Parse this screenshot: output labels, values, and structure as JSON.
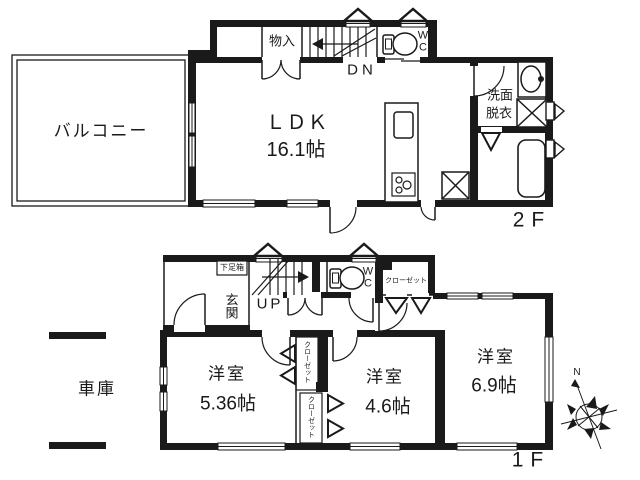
{
  "colors": {
    "line": "#1a1a1a",
    "background": "#ffffff"
  },
  "floor2": {
    "label": "2F",
    "balcony": "バルコニー",
    "ldk": "ＬＤＫ",
    "ldk_size": "16.1帖",
    "storage": "物入",
    "stairs": "DN",
    "wc_w": "W",
    "wc_c": "C",
    "washroom_line1": "洗面",
    "washroom_line2": "脱衣",
    "bathroom": "浴室"
  },
  "floor1": {
    "label": "1F",
    "entrance": "玄関",
    "shoebox": "下足箱",
    "stairs": "UP",
    "wc_w": "W",
    "wc_c": "C",
    "closet_top": "クローゼット",
    "room1": "洋室",
    "room1_size": "5.36帖",
    "room2": "洋室",
    "room2_size": "4.6帖",
    "room3": "洋室",
    "room3_size": "6.9帖",
    "closet_a": "クローゼット",
    "closet_b": "クローゼット",
    "garage": "車庫"
  },
  "compass": {
    "north": "N"
  }
}
